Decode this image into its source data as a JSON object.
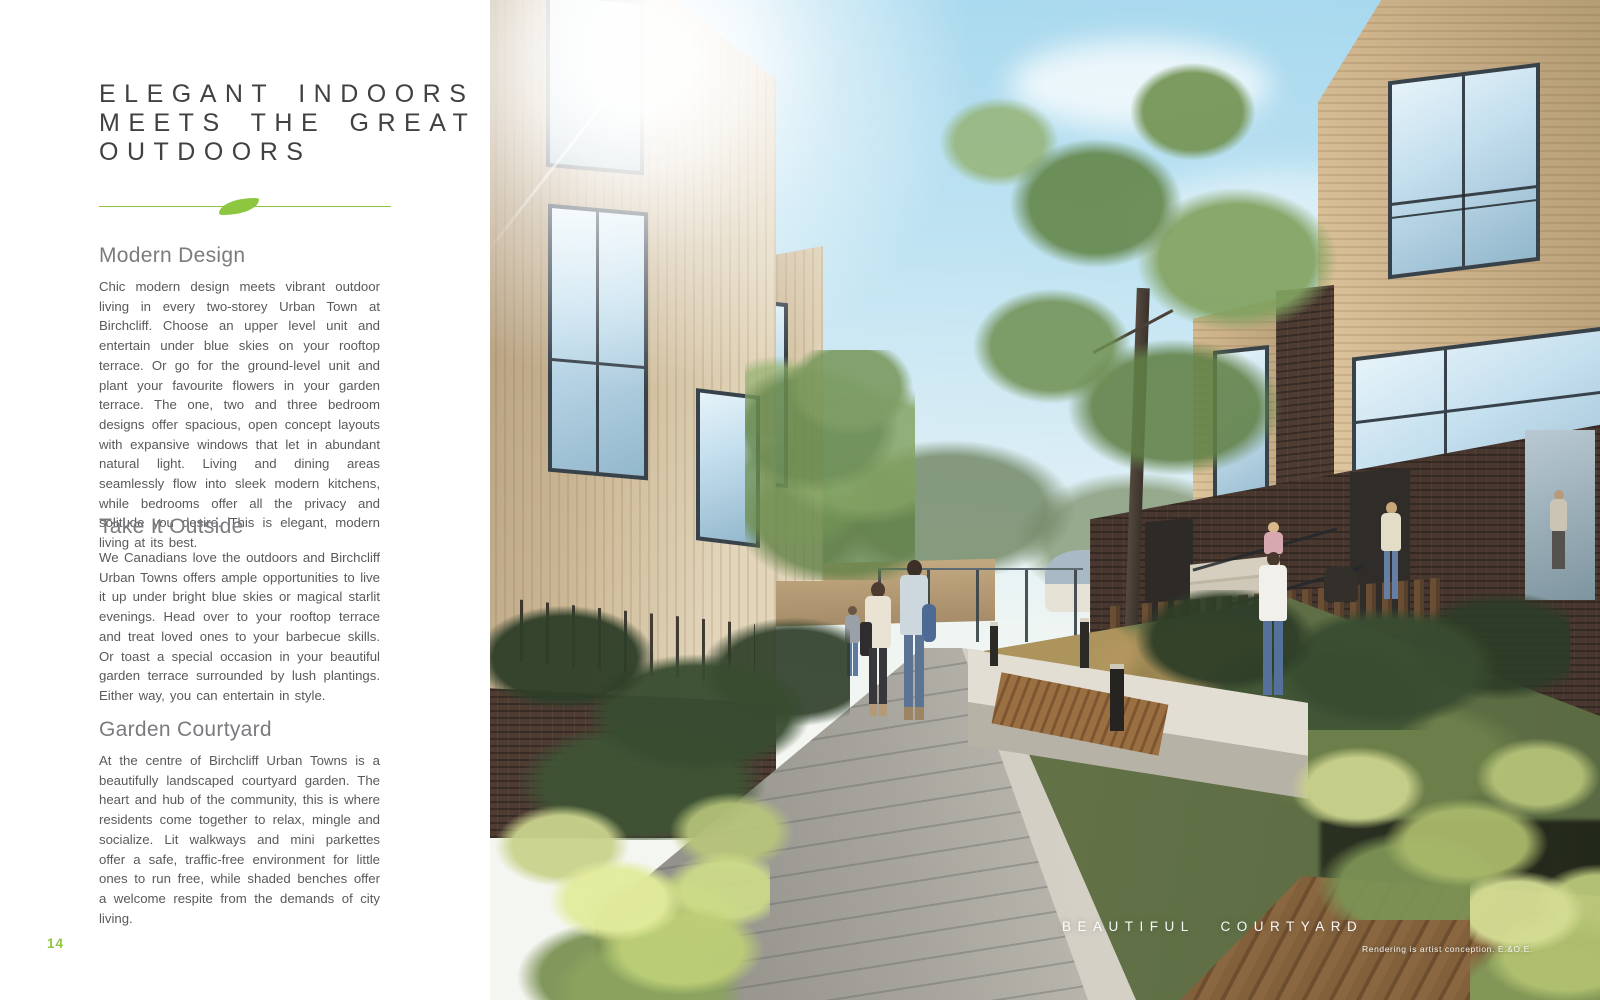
{
  "document": {
    "title_lines": [
      "ELEGANT INDOORS",
      "MEETS THE GREAT",
      "OUTDOORS"
    ],
    "sections": [
      {
        "heading": "Modern Design",
        "body": "Chic modern design meets vibrant outdoor living in every two-storey Urban Town at Birchcliff. Choose an upper level unit and entertain under blue skies on your rooftop terrace. Or go for the ground-level unit and plant your favourite flowers in your garden terrace. The one, two and three bedroom designs offer spacious, open concept layouts with expansive windows that let in abundant natural light. Living and dining areas seamlessly flow into sleek modern kitchens, while bedrooms offer all the privacy and solitude you desire. This is elegant, modern living at its best."
      },
      {
        "heading": "Take It Outside",
        "body": "We Canadians love the outdoors and Birchcliff Urban Towns offers ample opportunities to live it up under bright blue skies or magical starlit evenings. Head over to your rooftop terrace and treat loved ones to your barbecue skills. Or toast a special occasion in your beautiful garden terrace surrounded by lush plantings. Either way, you can entertain in style."
      },
      {
        "heading": "Garden Courtyard",
        "body": "At the centre of Birchcliff Urban Towns is a beautifully landscaped courtyard garden. The heart and hub of the community, this is where residents come together to relax, mingle and socialize. Lit walkways and mini parkettes offer a safe, traffic-free environment for little ones to run free, while shaded benches offer a welcome respite from the demands of city living."
      }
    ],
    "page_number": "14",
    "photo_caption": "BEAUTIFUL COURTYARD",
    "photo_disclaimer": "Rendering is artist conception. E.&O.E.",
    "colors": {
      "accent_green": "#8dc63f",
      "title_text": "#414042",
      "heading_text": "#7a7b7e",
      "body_text": "#58595b",
      "caption_text": "#ffffff"
    }
  }
}
